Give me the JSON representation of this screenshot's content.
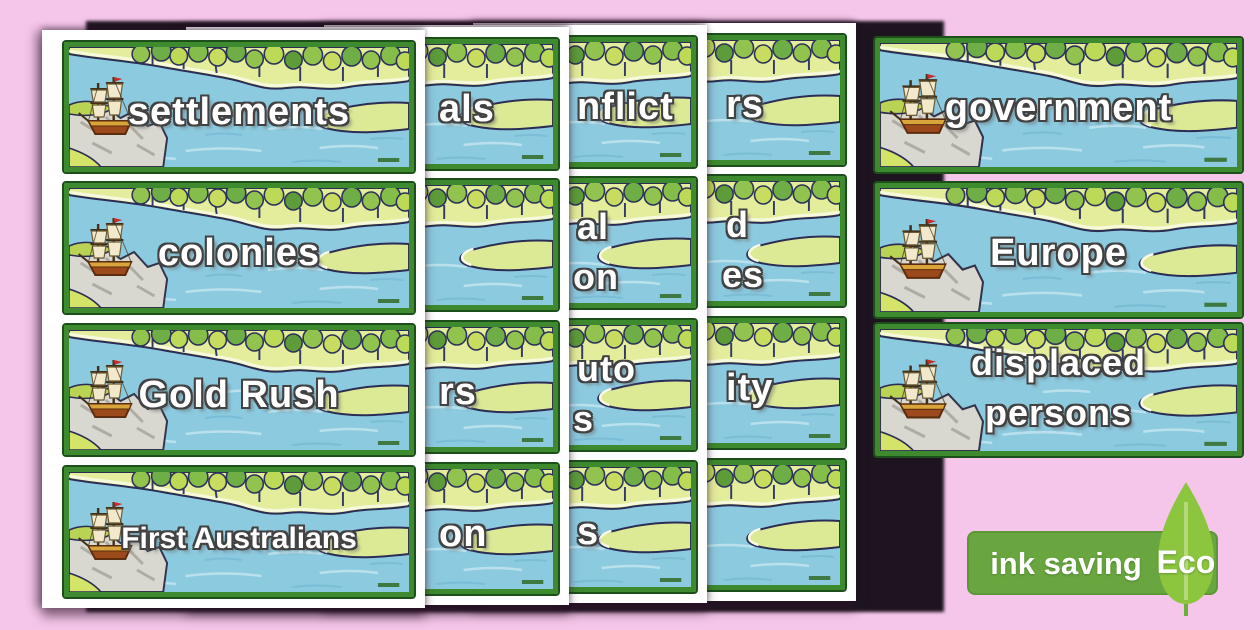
{
  "colors": {
    "background_pink": "#f6c6ea",
    "page_white": "#ffffff",
    "card_border_green": "#3e8a2e",
    "water_blue": "#8ccadf",
    "shore_yellow_green": "#e4ed9b",
    "badge_green": "#69a63f",
    "leaf_green": "#8cc63f",
    "text_white": "#ffffff"
  },
  "pages": [
    {
      "id": "page1",
      "cards": [
        {
          "type": "word",
          "text": "settlements"
        },
        {
          "type": "word",
          "text": "colonies"
        },
        {
          "type": "word",
          "text": "Gold Rush"
        },
        {
          "type": "word",
          "text": "First Australians",
          "long": true
        }
      ]
    },
    {
      "id": "page2",
      "cards": [
        {
          "type": "fragment",
          "text": "als"
        },
        {
          "type": "none"
        },
        {
          "type": "fragment",
          "text": "rs"
        },
        {
          "type": "fragment",
          "text": "on"
        }
      ]
    },
    {
      "id": "page3",
      "cards": [
        {
          "type": "fragment",
          "text": "nflict"
        },
        {
          "type": "fragment2",
          "line1": "al",
          "line2": "on"
        },
        {
          "type": "fragment2",
          "line1": "uto",
          "line2": "s"
        },
        {
          "type": "fragment",
          "text": "s"
        }
      ]
    },
    {
      "id": "page4",
      "cards": [
        {
          "type": "fragment",
          "text": "rs"
        },
        {
          "type": "fragment2",
          "line1": "d",
          "line2": "es"
        },
        {
          "type": "fragment",
          "text": "ity"
        },
        {
          "type": "none"
        }
      ]
    }
  ],
  "front_cards": [
    {
      "type": "word",
      "text": "government"
    },
    {
      "type": "word",
      "text": "Europe"
    },
    {
      "type": "word2",
      "line1": "displaced",
      "line2": "persons"
    }
  ],
  "eco_badge": {
    "label": "ink saving",
    "eco": "Eco"
  }
}
